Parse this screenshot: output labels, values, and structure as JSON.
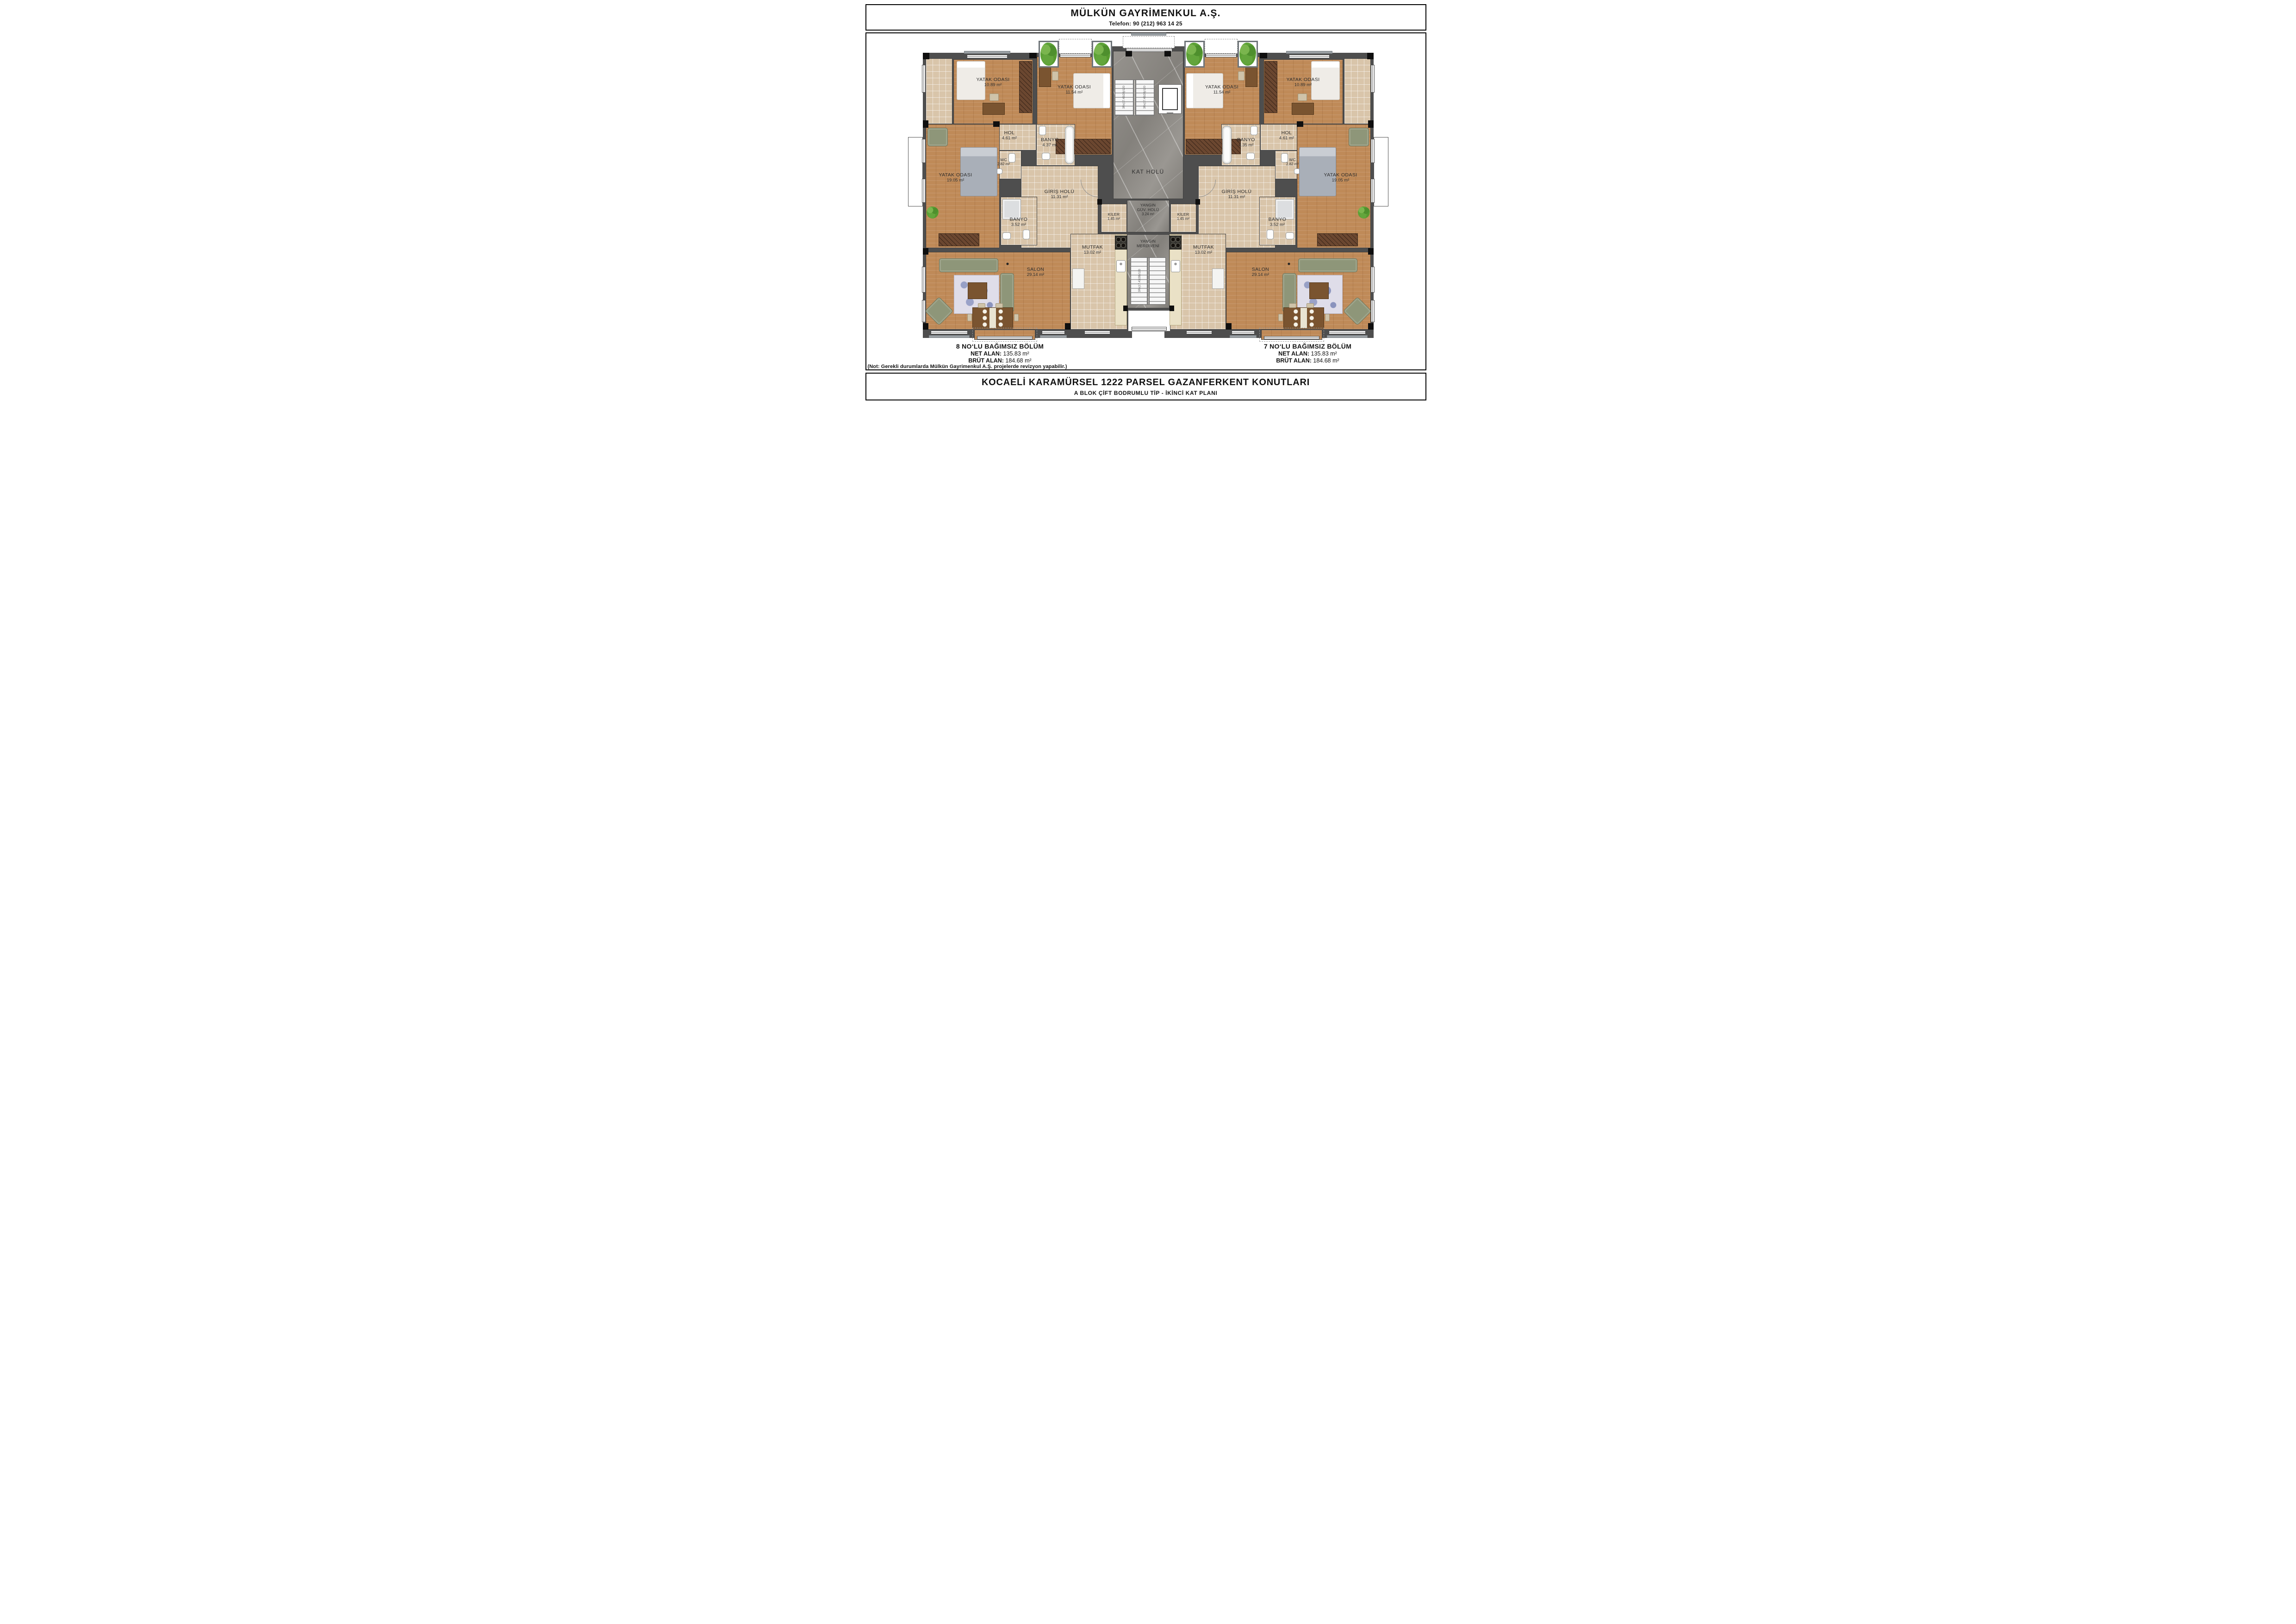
{
  "header": {
    "company": "MÜLKÜN GAYRİMENKUL A.Ş.",
    "phone": "Telefon: 90 (212) 963 14 25"
  },
  "plan": {
    "core": {
      "kat_holu": "KAT HOLÜ",
      "yangin_guv_line1": "YANGIN",
      "yangin_guv_line2": "GÜV. HOLÜ",
      "yangin_guv_area": "3.24 m²",
      "yangin_merdiveni_line1": "YANGIN",
      "yangin_merdiveni_line2": "MERDİVENİ",
      "stair_note": "3Rx(17.43/28)/120"
    },
    "unit8": {
      "yatak1": {
        "name": "YATAK ODASI",
        "area": "10.89 m²"
      },
      "yatak2": {
        "name": "YATAK ODASI",
        "area": "11.54 m²"
      },
      "hol": {
        "name": "HOL",
        "area": "4.61 m²"
      },
      "banyo": {
        "name": "BANYO",
        "area": "4.37 m²"
      },
      "wc": {
        "name": "WC",
        "area": "2.82 m²"
      },
      "yatak_buyuk": {
        "name": "YATAK ODASI",
        "area": "19.05 m²"
      },
      "giris": {
        "name": "GİRİŞ HOLÜ",
        "area": "11.31 m²"
      },
      "banyo2": {
        "name": "BANYO",
        "area": "3.52 m²"
      },
      "kiler": {
        "name": "KİLER",
        "area": "1.45 m²"
      },
      "mutfak": {
        "name": "MUTFAK",
        "area": "13.02 m²"
      },
      "salon": {
        "name": "SALON",
        "area": "29.14 m²"
      }
    },
    "unit7": {
      "yatak1": {
        "name": "YATAK ODASI",
        "area": "10.89 m²"
      },
      "yatak2": {
        "name": "YATAK ODASI",
        "area": "11.54 m²"
      },
      "hol": {
        "name": "HOL",
        "area": "4.61 m²"
      },
      "banyo": {
        "name": "BANYO",
        "area": "4.35 m²"
      },
      "wc": {
        "name": "WC",
        "area": "2.82 m²"
      },
      "yatak_buyuk": {
        "name": "YATAK ODASI",
        "area": "19.05 m²"
      },
      "giris": {
        "name": "GİRİŞ HOLÜ",
        "area": "11.31 m²"
      },
      "banyo2": {
        "name": "BANYO",
        "area": "3.52 m²"
      },
      "kiler": {
        "name": "KİLER",
        "area": "1.45 m²"
      },
      "mutfak": {
        "name": "MUTFAK",
        "area": "13.02 m²"
      },
      "salon": {
        "name": "SALON",
        "area": "29.14 m²"
      }
    }
  },
  "units": {
    "unit8": {
      "title": "8 NO‘LU BAĞIMSIZ BÖLÜM",
      "net_label": "NET ALAN:",
      "net_value": "135.83 m²",
      "brut_label": "BRÜT ALAN:",
      "brut_value": "184.68 m²"
    },
    "unit7": {
      "title": "7 NO‘LU BAĞIMSIZ BÖLÜM",
      "net_label": "NET ALAN:",
      "net_value": "135.83 m²",
      "brut_label": "BRÜT ALAN:",
      "brut_value": "184.68 m²"
    }
  },
  "note": "(Not: Gerekli durumlarda Mülkün Gayrimenkul A.Ş. projelerde revizyon yapabilir.)",
  "footer": {
    "title": "KOCAELİ KARAMÜRSEL 1222 PARSEL GAZANFERKENT KONUTLARI",
    "subtitle": "A BLOK ÇİFT BODRUMLU TİP - İKİNCİ KAT PLANI"
  },
  "colors": {
    "wood": "#bf8a58",
    "tile": "#d9c5aa",
    "marble": "#8e8b86",
    "wall": "#4e4e4e",
    "plant": "#5ca136",
    "sofa": "#8e9679"
  }
}
